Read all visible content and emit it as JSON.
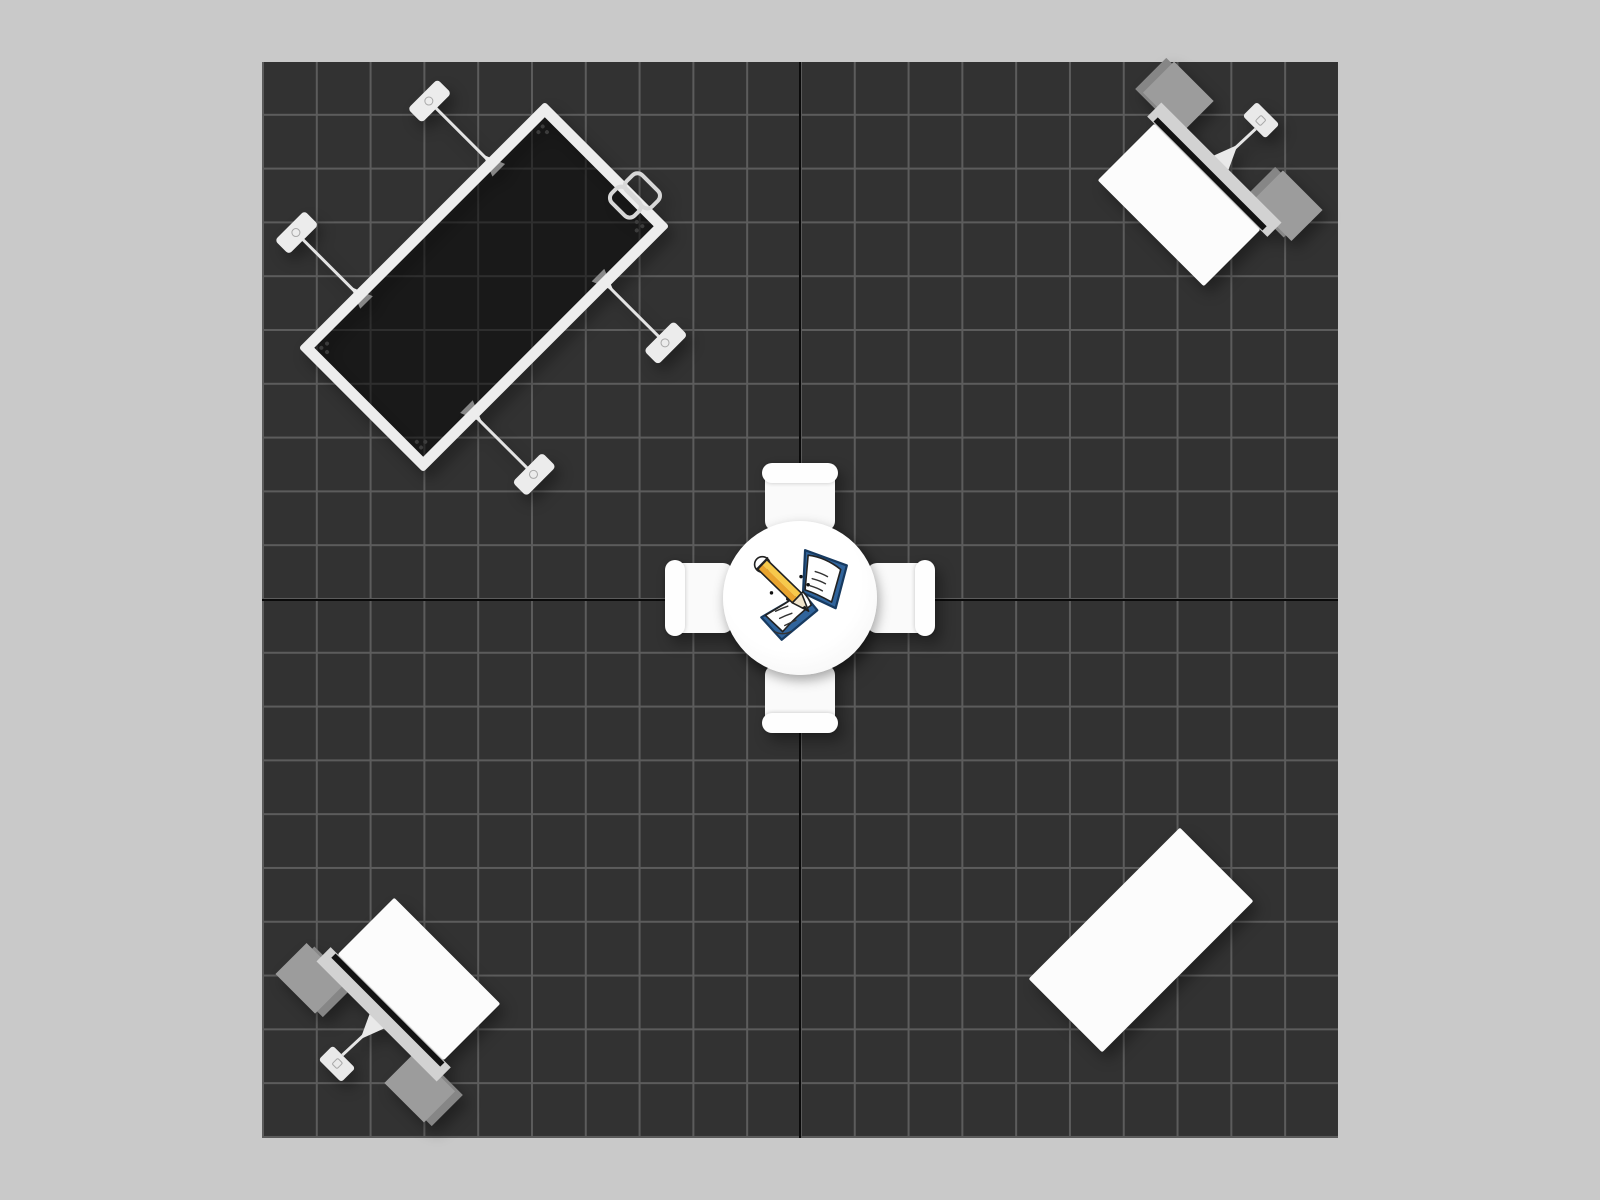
{
  "scene": {
    "name": "trade-show-booth-floor-plan",
    "view": "top-down",
    "floor": {
      "grid_columns": 20,
      "grid_rows": 20
    },
    "objects": [
      {
        "name": "backwall-display-frame",
        "position": "top-left",
        "stabilizer_feet": 4,
        "clamp_brackets": 2
      },
      {
        "name": "workstation-counter",
        "position": "top-right",
        "wing_panels": 2,
        "stabilizer_feet": 1
      },
      {
        "name": "round-table-with-chairs",
        "position": "center",
        "chairs": 4,
        "icon": "notebook-pencil-icon"
      },
      {
        "name": "workstation-counter",
        "position": "bottom-left",
        "wing_panels": 2,
        "stabilizer_feet": 1
      },
      {
        "name": "rectangular-counter",
        "position": "bottom-right"
      }
    ]
  },
  "palette": {
    "canvas-bg": "#c9c9c9",
    "floor-bg": "#323232",
    "grid-line": "#5c5c5c",
    "axis-line": "#0a0a0a",
    "frame-white": "#ededed",
    "panel-tint": "rgba(0,0,0,0.42)",
    "wing-gray": "#9c9c9c",
    "wing-gray-dark": "#868686",
    "bar-gray": "#d2d2d2",
    "stripe-dark": "#121212",
    "furniture-white": "#fcfcfc",
    "book-blue": "#30649c",
    "pencil-yellow": "#f7c94b",
    "pencil-orange": "#e9a42e"
  }
}
